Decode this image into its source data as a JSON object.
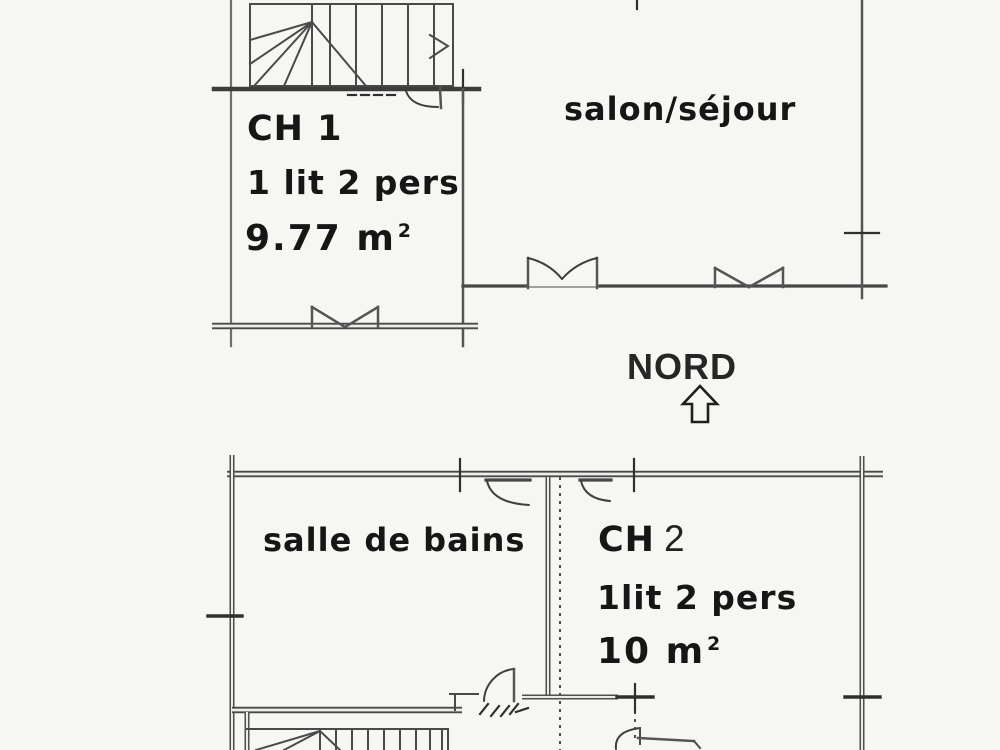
{
  "compass": {
    "label": "NORD"
  },
  "upper_floor": {
    "bedroom1": {
      "name": "CH 1",
      "bed": "1 lit 2 pers",
      "area": "9.77 m",
      "area_sup": "2"
    },
    "living": {
      "name": "salon/séjour"
    }
  },
  "lower_floor": {
    "bathroom": {
      "name": "salle de bains"
    },
    "bedroom2": {
      "name": "CH",
      "number": "2",
      "bed": "1lit 2 pers",
      "area": "10 m",
      "area_sup": "2"
    }
  }
}
